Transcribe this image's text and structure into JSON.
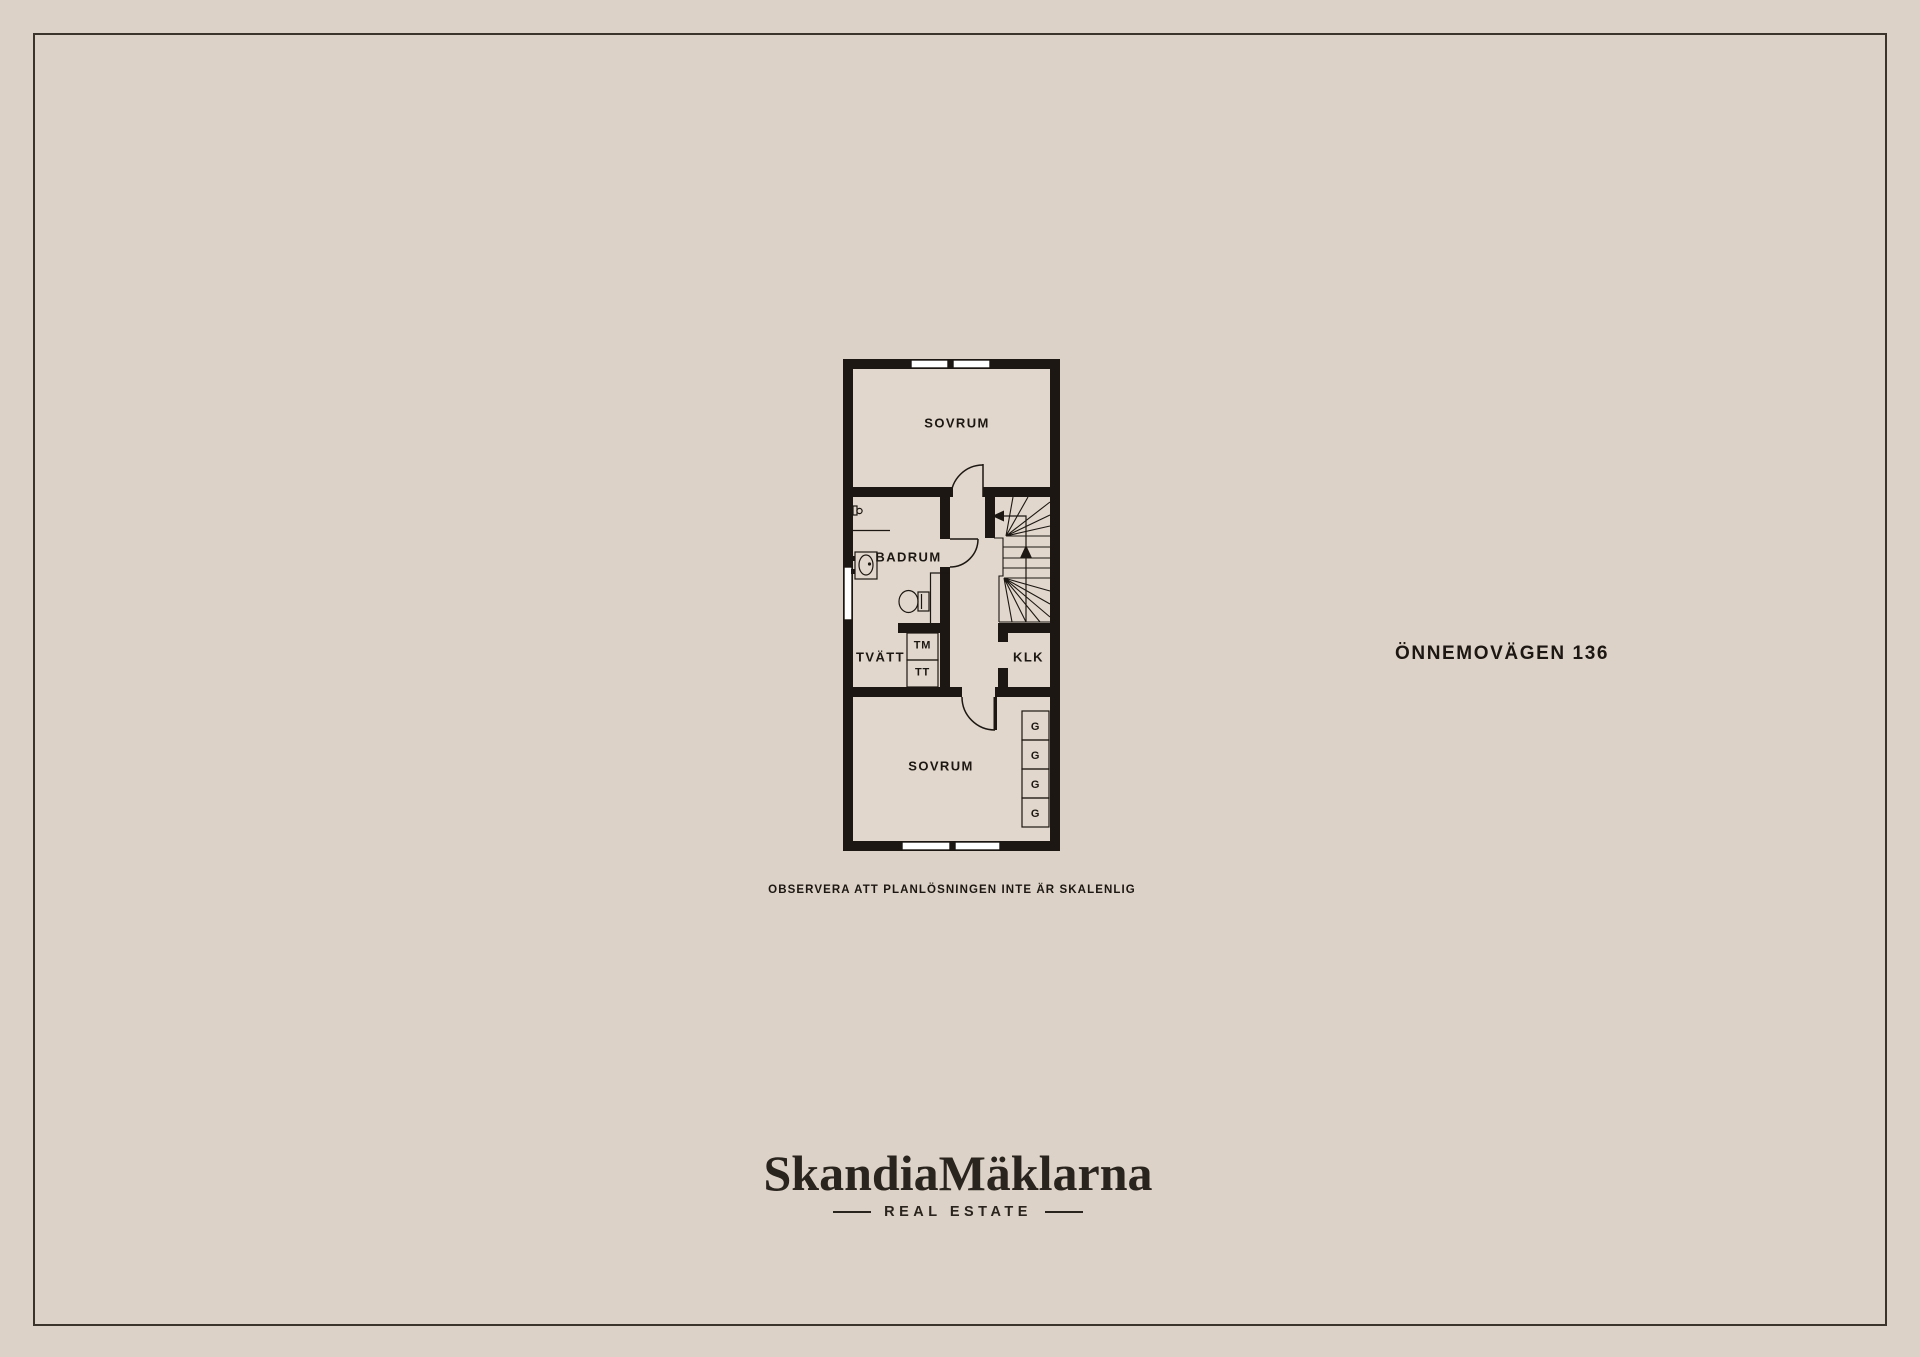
{
  "page": {
    "background": "#dcd2c7",
    "frame_color": "#3b342c"
  },
  "address": "ÖNNEMOVÄGEN 136",
  "disclaimer": "OBSERVERA ATT PLANLÖSNINGEN INTE ÄR SKALENLIG",
  "logo": {
    "wordmark": "SkandiaMäklarna",
    "tagline": "REAL ESTATE"
  },
  "floorplan": {
    "ink_color": "#1c1712",
    "floor_color": "#e1d7cc",
    "labels": {
      "sovrum_top": "SOVRUM",
      "badrum": "BADRUM",
      "tvatt": "TVÄTT",
      "washing_machine": "TM",
      "dryer": "TT",
      "klk": "KLK",
      "sovrum_bottom": "SOVRUM",
      "wardrobe": "G"
    }
  }
}
